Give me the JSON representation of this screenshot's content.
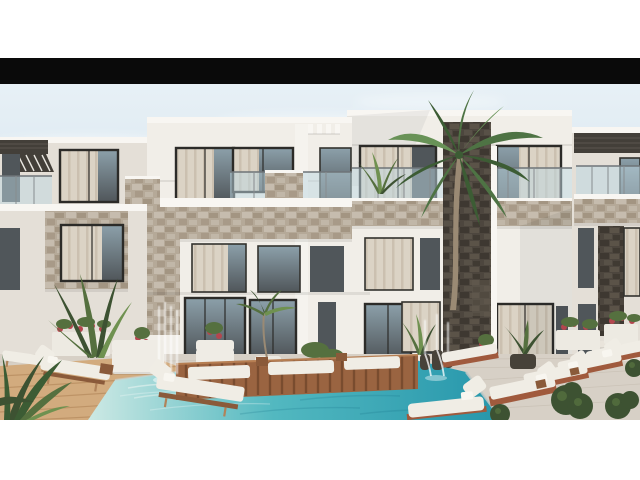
{
  "photo": {
    "alt": "Architectural rendering of a modern three-storey white apartment complex with glass balconies, stone-clad pillars, palm trees, fountains and a turquoise swimming pool surrounded by wooden decks and white sun loungers",
    "letterbox_color": "#0a0a0a"
  },
  "colors": {
    "page_bg": "#ffffff",
    "letterbox": "#0a0a0a",
    "sky_top": "#eaf2f7",
    "sky_bottom": "#c3d8e6",
    "cloud": "#ffffff",
    "wall_bright": "#f1eee8",
    "wall_mid": "#e4dfd7",
    "roof_cap": "#f8f6f2",
    "pilaster": "#f5f3ee",
    "frame_dark": "#2c2b28",
    "glass_dark": "#50565a",
    "glass_light": "#8ca0aa",
    "curtain": "#dbd3c5",
    "curtain_shade": "#c7bcab",
    "stone_base": "#b5a998",
    "stone_dark": "#9c8e7a",
    "stone_light": "#c9c0b2",
    "slate_base": "#4d463e",
    "slate_dark": "#3b352e",
    "slate_light": "#645b4f",
    "pergola": "#433f39",
    "balustrade_glass": "#bdd7e1",
    "patio": "#d7d0c6",
    "step": "#e9e4db",
    "deck": "#d2ab7e",
    "deck_line": "#b98e61",
    "platform": "#9a6441",
    "platform_slat": "#6f4529",
    "platform_edge": "#b67e52",
    "pool_shallow": "#cde9e4",
    "pool_mid": "#52b8c0",
    "pool_deep": "#2696ab",
    "lounger": "#f0ede5",
    "lounger_base": "#a05a3d",
    "lounger_wood": "#8a5a3a",
    "pillow": "#f8f6f0",
    "sofa": "#efece5",
    "planter_white": "#edeae2",
    "pot_dark": "#474239",
    "plant_dark": "#3d5232",
    "plant_mid": "#55703f",
    "plant_light": "#6f9150",
    "palm_green": "#4e7344",
    "palm_dark": "#3c5c34",
    "palm_light": "#689257",
    "trunk": "#9a8a74",
    "flower_red": "#b4464e",
    "fountain_water": "#ffffff"
  }
}
